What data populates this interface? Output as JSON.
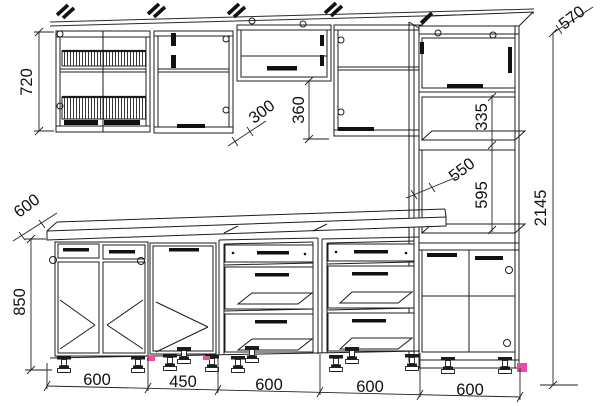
{
  "drawing": {
    "type": "kitchen-cabinet-assembly-technical-drawing",
    "dims": {
      "wall_cabinet_height": "720",
      "worktop_depth": "600",
      "base_cabinet_height": "850",
      "wall_cabinet_depth": "300",
      "flip_gap_height": "360",
      "tall_upper_niche_height": "335",
      "tall_cabinet_depth": "550",
      "tall_top_depth": "570",
      "appliance_niche_height": "595",
      "total_height": "2145",
      "base_widths": [
        "600",
        "450",
        "600",
        "600",
        "600"
      ]
    },
    "colors": {
      "line": "#1c1c1c",
      "marker_pink": "#ec4da3"
    }
  }
}
